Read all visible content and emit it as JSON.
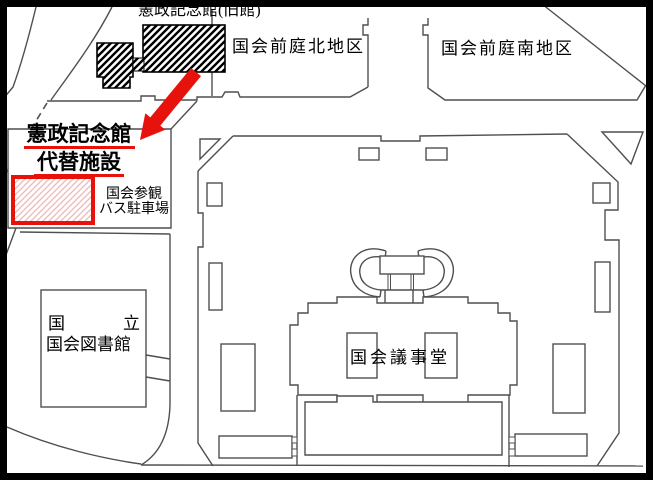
{
  "map": {
    "labels": {
      "old_hall": "憲政記念館(旧館)",
      "north_garden": "国会前庭北地区",
      "south_garden": "国会前庭南地区",
      "replacement_line1": "憲政記念館",
      "replacement_line2": "代替施設",
      "bus_parking_line1": "国会参観",
      "bus_parking_line2": "バス駐車場",
      "library_line1_left": "国",
      "library_line1_right": "立",
      "library_line2": "国会図書館",
      "diet_building": "国会議事堂"
    },
    "colors": {
      "background": "#ffffff",
      "map_line": "#4f4f4f",
      "building_outline": "#000000",
      "accent_red": "#e8120d",
      "hatch_pink": "#f2b5b5",
      "frame_black": "#000000"
    }
  }
}
